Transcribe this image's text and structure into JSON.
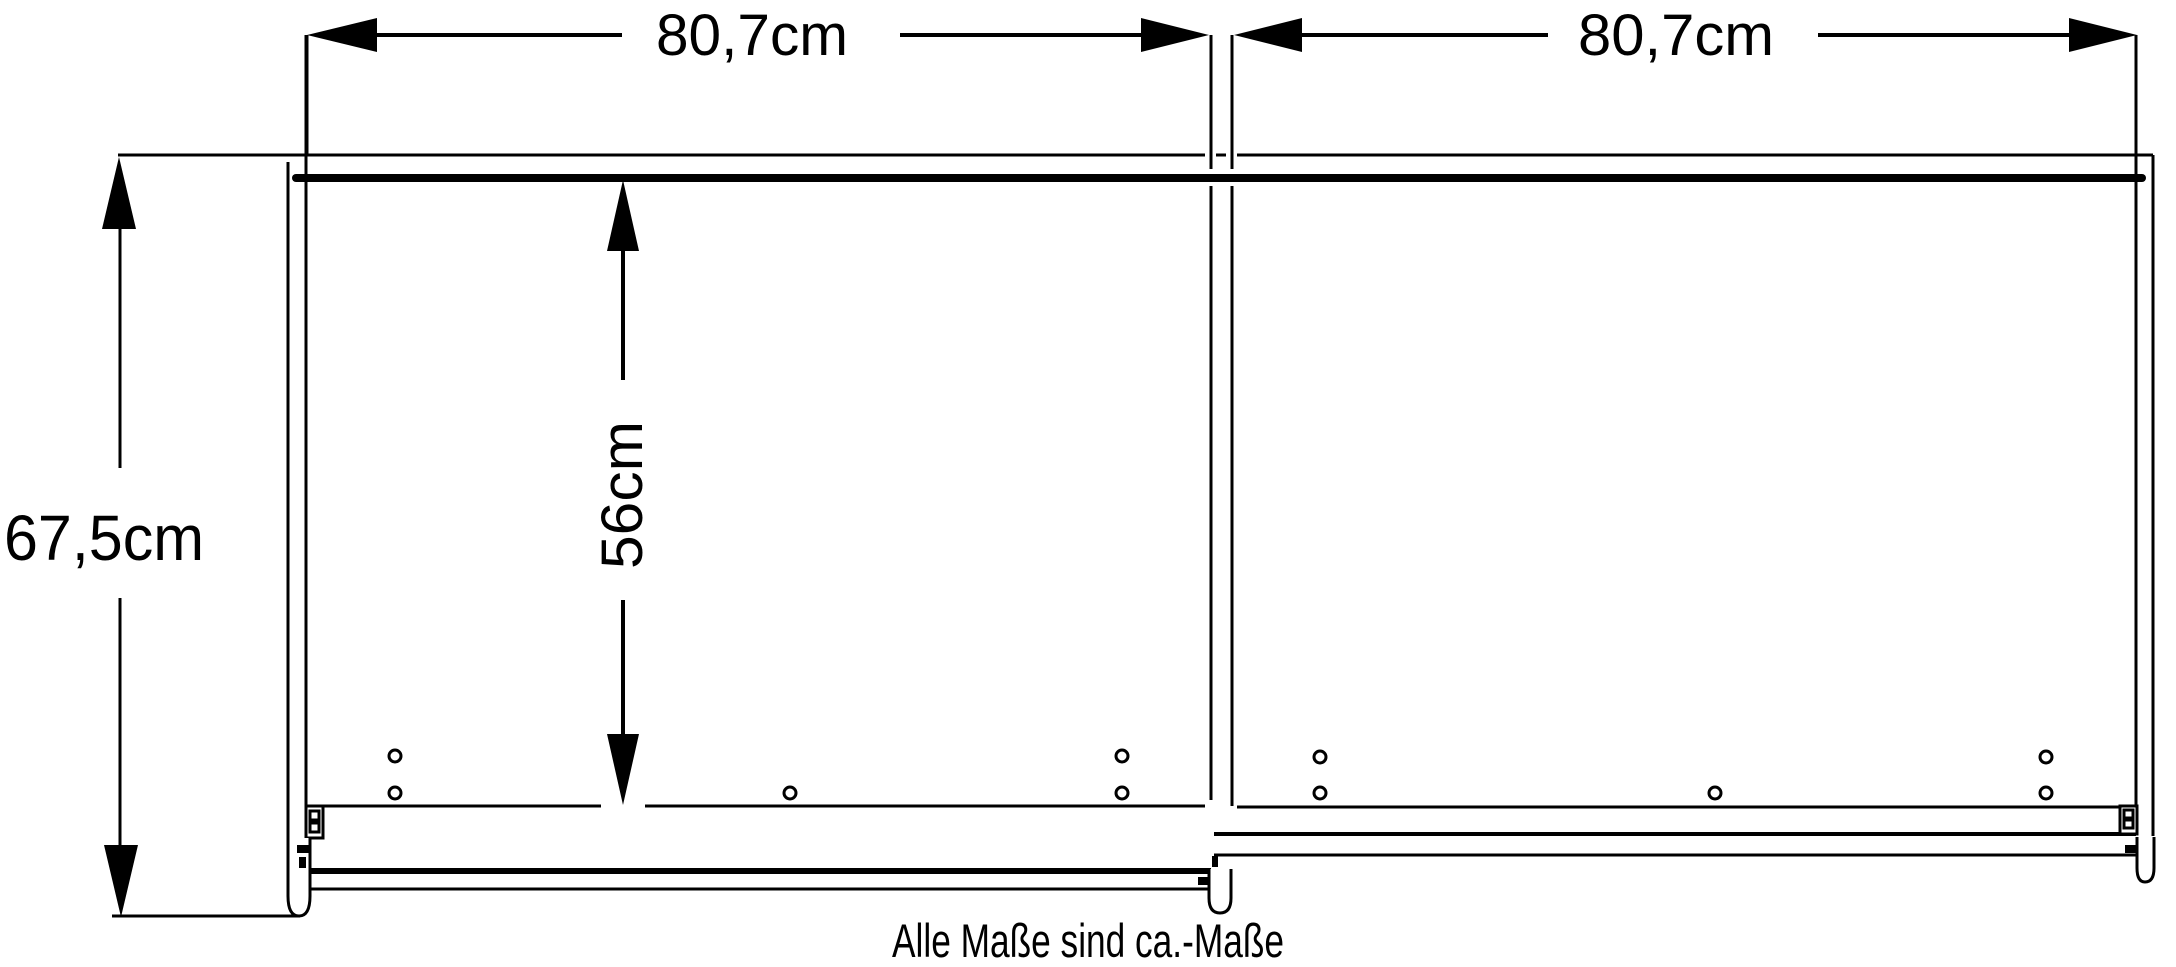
{
  "diagram": {
    "type": "furniture-dimension-drawing",
    "background_color": "#ffffff",
    "line_color": "#000000",
    "dimensions": {
      "width_left": {
        "label": "80,7cm"
      },
      "width_right": {
        "label": "80,7cm"
      },
      "height": {
        "label": "67,5cm"
      },
      "interior_height": {
        "label": "56cm"
      }
    },
    "caption": "Alle Maße sind ca.-Maße"
  }
}
